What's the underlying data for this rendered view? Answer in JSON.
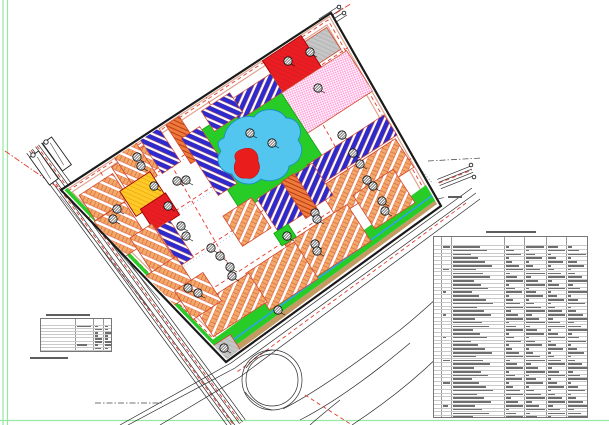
{
  "canvas": {
    "width": 609,
    "height": 425,
    "background": "#FFFFFF"
  },
  "frame": {
    "color": "#97E8A5",
    "left_lines_x": [
      3,
      7.5
    ],
    "bottom_line_y": 420.5
  },
  "palette": {
    "residential_lot": "#F2A968",
    "lot_line": "#D2482E",
    "commercial_blue": "#2B2BD0",
    "mixed_orange": "#EE7A3C",
    "school_yellow": "#FFC929",
    "civic_red": "#EC1C24",
    "healthcare_pink": "#FF9ED9",
    "park_green": "#27CC27",
    "lake_blue": "#52C6EF",
    "island_red": "#EA1D1D",
    "utility_gray": "#C6C6C6",
    "road_white": "#FFFFFF",
    "road_dash_red": "#E23B2E",
    "sidewalk_tan": "#DFA58F",
    "embankment_tan": "#C49A62",
    "canal_blue": "#2FA3E8",
    "boundary_black": "#1A1A1A",
    "frame_green": "#97E8A5",
    "table_line": "#8A8A8A",
    "faux_text": "#6E6E6E"
  },
  "map": {
    "boundary_polygon": [
      [
        331,
        13
      ],
      [
        441,
        206
      ],
      [
        226,
        362
      ],
      [
        61,
        190
      ]
    ],
    "rotation_deg": -33,
    "zone_types": [
      {
        "name": "residential-lot-rows",
        "color": "#F2A968"
      },
      {
        "name": "commercial-blue-strips",
        "color": "#2B2BD0"
      },
      {
        "name": "mixed-orange-strip",
        "color": "#EE7A3C"
      },
      {
        "name": "school-yellow-block",
        "color": "#FFC929"
      },
      {
        "name": "civic-red-block",
        "color": "#EC1C24"
      },
      {
        "name": "healthcare-pink-block",
        "color": "#FF9ED9"
      },
      {
        "name": "park-green",
        "color": "#27CC27"
      },
      {
        "name": "lake",
        "color": "#52C6EF"
      },
      {
        "name": "utility-gray-block",
        "color": "#C6C6C6"
      }
    ],
    "markers": {
      "icon": "hatched-circle",
      "positions": [
        [
          137,
          157
        ],
        [
          141,
          166
        ],
        [
          154,
          186
        ],
        [
          168,
          206
        ],
        [
          177,
          181
        ],
        [
          186,
          180
        ],
        [
          117,
          209
        ],
        [
          113,
          219
        ],
        [
          181,
          226
        ],
        [
          186,
          236
        ],
        [
          211,
          248
        ],
        [
          220,
          256
        ],
        [
          230,
          267
        ],
        [
          232,
          276
        ],
        [
          188,
          288
        ],
        [
          198,
          293
        ],
        [
          250,
          133
        ],
        [
          272,
          143
        ],
        [
          310,
          52
        ],
        [
          288,
          61
        ],
        [
          318,
          88
        ],
        [
          342,
          135
        ],
        [
          353,
          153
        ],
        [
          360,
          164
        ],
        [
          367,
          180
        ],
        [
          373,
          186
        ],
        [
          382,
          201
        ],
        [
          385,
          211
        ],
        [
          315,
          213
        ],
        [
          317,
          219
        ],
        [
          287,
          236
        ],
        [
          315,
          244
        ],
        [
          317,
          251
        ],
        [
          278,
          310
        ],
        [
          224,
          348
        ]
      ]
    }
  },
  "tables": {
    "land_use_table": {
      "x": 433,
      "y": 236,
      "width": 155,
      "height": 182,
      "header_height": 8,
      "rows": 46,
      "col_edges": [
        0,
        7,
        17,
        70,
        90,
        112,
        132,
        155
      ],
      "title_bar": {
        "x": 486,
        "y": 231,
        "width": 50
      },
      "text_legible": false
    },
    "summary_table": {
      "x": 40,
      "y": 318,
      "width": 72,
      "height": 34,
      "header_height": 6,
      "rows": 9,
      "col_edges": [
        0,
        34,
        52,
        62,
        72
      ],
      "title_bar": {
        "x": 46,
        "y": 314,
        "width": 44
      },
      "note_bar": {
        "x": 30,
        "y": 357,
        "width": 38
      },
      "text_legible": false
    },
    "edge_note_bar": {
      "x": 448,
      "y": 196,
      "width": 14
    }
  }
}
